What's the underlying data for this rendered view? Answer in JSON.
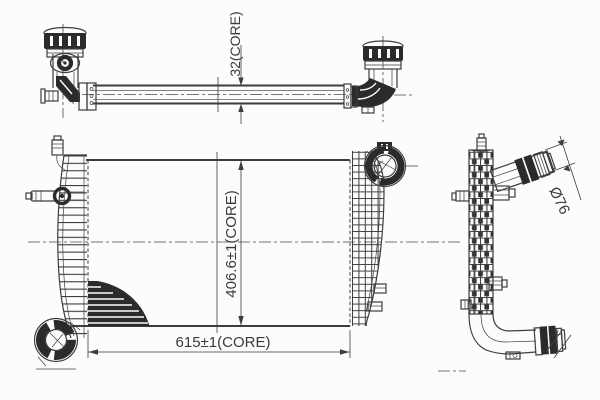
{
  "drawing": {
    "background_color": "#fcfcfc",
    "line_color": "#3d3d3d",
    "dark_fill_color": "#2b2b2b",
    "text_color": "#3a3a3a"
  },
  "dimensions": {
    "core_thickness_label": "32(CORE)",
    "core_height_label": "406.6±1(CORE)",
    "core_width_label": "615±1(CORE)",
    "pipe_diameter_label": "Ø76"
  }
}
